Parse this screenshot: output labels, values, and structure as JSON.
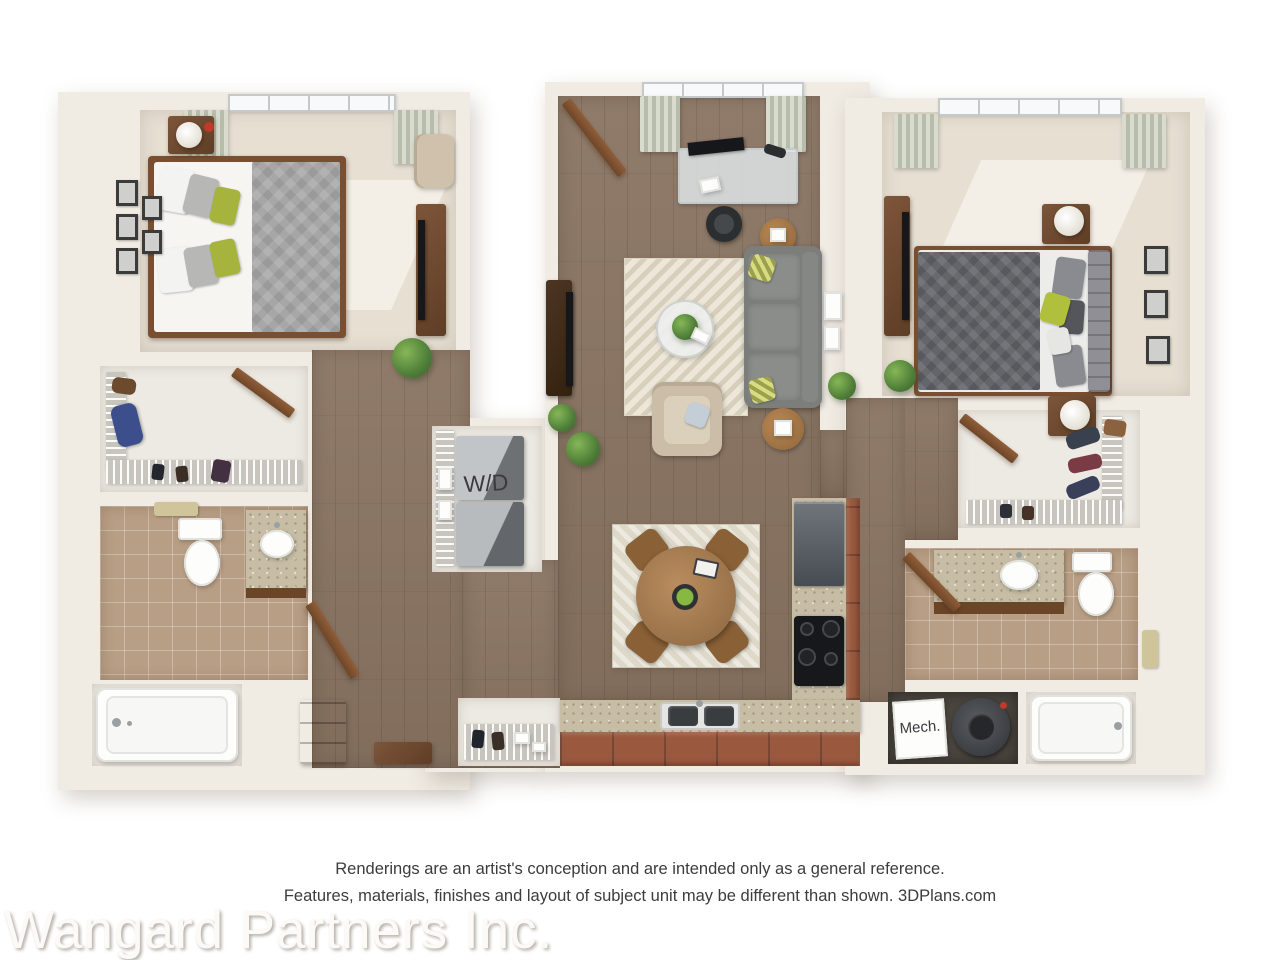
{
  "labels": {
    "washer_dryer": "W/D",
    "mechanical": "Mech."
  },
  "disclaimer": {
    "line1": "Renderings are an artist's conception and are intended only as a general reference.",
    "line2": "Features, materials, finishes and layout of subject unit may be different than shown. 3DPlans.com"
  },
  "watermark": "Wangard Partners Inc.",
  "palette": {
    "background": "#ffffff",
    "wall": "#f0ebe3",
    "wood_floor": "#8a7462",
    "carpet": "#e6dfd2",
    "bath_tile": "#b89e84",
    "granite_counter": "#c6bda4",
    "cabinet_terracotta": "#9a593f",
    "sofa_gray": "#7c7e7b",
    "bed_duvet_gray": "#64656b",
    "accent_green_pillow": "#a6b33d",
    "plant_green": "#4e7d38",
    "door_wood": "#8a5a38",
    "label_text": "#3a3b3e"
  }
}
